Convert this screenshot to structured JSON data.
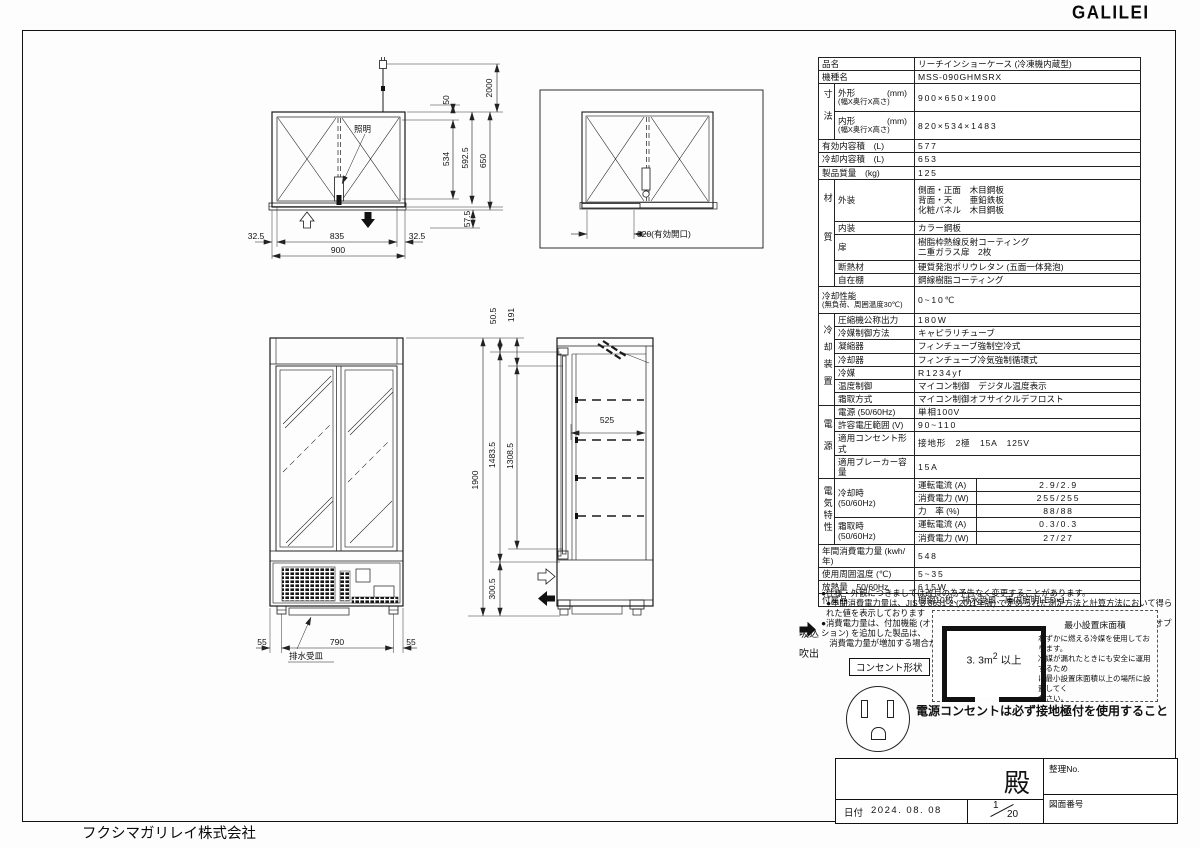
{
  "page": {
    "logo": "GALILEI",
    "company": "フクシマガリレイ株式会社"
  },
  "spec": {
    "name_label": "品名",
    "name_value": "リーチインショーケース (冷凍機内蔵型)",
    "model_label": "機種名",
    "model_value": "MSS-090GHMSRX",
    "dims_group": "寸法",
    "outer_name": "外形",
    "outer_unit": "(mm)",
    "outer_sub": "(幅X奥行X高さ)",
    "outer_value": "900×650×1900",
    "inner_name": "内形",
    "inner_unit": "(mm)",
    "inner_sub": "(幅X奥行X高さ)",
    "inner_value": "820×534×1483",
    "effective_label": "有効内容積　(L)",
    "effective_value": "577",
    "cooled_label": "冷却内容積　(L)",
    "cooled_value": "653",
    "weight_label": "製品質量　(kg)",
    "weight_value": "125",
    "material_group": "材質",
    "exterior_label": "外装",
    "exterior_value": "側面・正面　木目鋼板\n背面・天　　亜鉛鉄板\n化粧パネル　木目鋼板",
    "interior_label": "内装",
    "interior_value": "カラー鋼板",
    "door_label": "扉",
    "door_value": "樹脂枠熱線反射コーティング\n二重ガラス扉　2枚",
    "insulation_label": "断熱材",
    "insulation_value": "硬質発泡ポリウレタン (五面一体発泡)",
    "shelf_label": "自在棚",
    "shelf_value": "鋼線樹脂コーティング",
    "perf_name": "冷却性能",
    "perf_cond": "(無負荷、周囲温度30℃)",
    "perf_value": "0~10℃",
    "cooling_group": "冷却装置",
    "comp_label": "圧縮機公称出力",
    "comp_value": "180W",
    "refctrl_label": "冷媒制御方法",
    "refctrl_value": "キャピラリチューブ",
    "cond_label": "凝縮器",
    "cond_value": "フィンチューブ強制空冷式",
    "cooler_label": "冷却器",
    "cooler_value": "フィンチューブ冷気強制循環式",
    "ref_label": "冷媒",
    "ref_value": "R1234yf",
    "temp_label": "温度制御",
    "temp_value": "マイコン制御　デジタル温度表示",
    "defrost_label": "霜取方式",
    "defrost_value": "マイコン制御オフサイクルデフロスト",
    "power_group": "電源",
    "supply_label": "電源 (50/60Hz)",
    "supply_value": "単相100V",
    "voltage_label": "許容電圧範囲 (V)",
    "voltage_value": "90~110",
    "plug_label": "適用コンセント形式",
    "plug_value": "接地形　2極　15A　125V",
    "breaker_label": "適用ブレーカー容量",
    "breaker_value": "15A",
    "elec_group": "電気特性",
    "cooling_mode": "冷却時\n(50/60Hz)",
    "defrost_mode": "霜取時\n(50/60Hz)",
    "current_label": "運転電流 (A)",
    "cool_current": "2.9/2.9",
    "watt_label": "消費電力 (W)",
    "cool_watt": "255/255",
    "pf_label": "力　率 (%)",
    "pf_value": "88/88",
    "def_current_label": "運転電流 (A)",
    "def_current": "0.3/0.3",
    "def_watt_label": "消費電力 (W)",
    "def_watt": "27/27",
    "annual_label": "年間消費電力量 (kwh/年)",
    "annual_value": "548",
    "ambient_label": "使用周囲温度 (℃)",
    "ambient_value": "5~35",
    "heat_label": "放熱量　50/60Hz",
    "heat_value": "615W",
    "acc_label": "付属品",
    "acc_value": "棚網10枚、排水受皿、庫内照明LED×1"
  },
  "notes": [
    "●仕様・外観につきましては改良の為予告なく変更することがあります。",
    "●年間消費電力量は、JIS B 8631-2 (2011年版) で定められた測定方法と計算方法において得られた値を表示しております",
    "●消費電力量は、付加機能 (オプション) のない標準品により表示しております。付加機能 (オプション) を追加した製品は、\n　消費電力量が増加する場合があります。"
  ],
  "airflow": {
    "suction": "吸込",
    "blow": "吹出"
  },
  "outlet": {
    "shape_label": "コンセント形状",
    "warning": "電源コンセントは必ず接地極付を使用すること"
  },
  "min_area": {
    "title": "最小設置床面積",
    "value_main": "3. 3m",
    "value_sup": "2",
    "value_suffix": "以上",
    "caption": "わずかに燃える冷媒を使用しております。\n冷媒が漏れたときにも安全に運用するため\nに最小設置床面積以上の場所に設置してく\nださい。"
  },
  "title_block": {
    "addressee": "殿",
    "ref_no_label": "整理No.",
    "date_label": "日付",
    "date_value": "2024. 08. 08",
    "scale_num": "1",
    "scale_den": "20",
    "drawing_no_label": "図面番号"
  },
  "dims": {
    "plan": {
      "cord": "2000",
      "light_off": "50",
      "inner_d": "534",
      "d592": "592.5",
      "depth": "650",
      "sill": "57.5",
      "edge": "32.5",
      "glass_w": "835",
      "width": "900",
      "lighting": "照明"
    },
    "open": {
      "opening": "320(有効開口)"
    },
    "front": {
      "height": "1900",
      "leg_edge": "55",
      "leg_span": "790",
      "drain": "排水受皿"
    },
    "side": {
      "top": "50.5",
      "d191": "191",
      "case_h": "1483.5",
      "door_h": "1308.5",
      "depth": "525",
      "base": "300.5"
    }
  }
}
